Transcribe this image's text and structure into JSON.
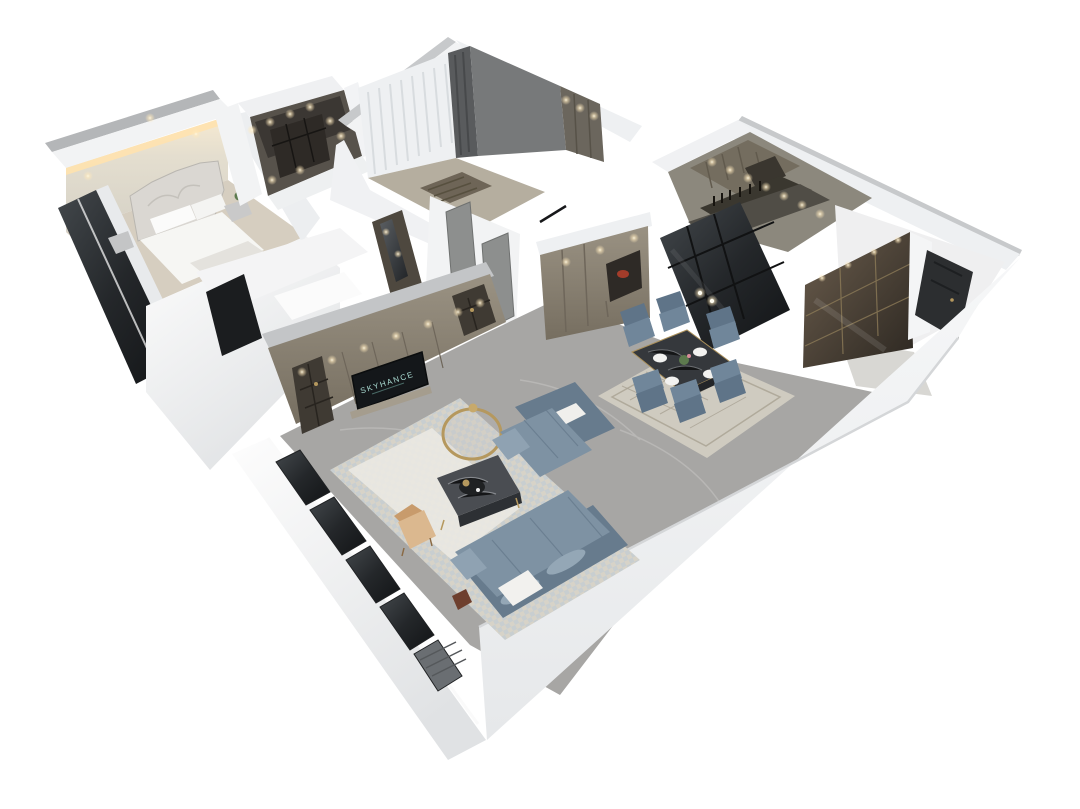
{
  "tv": {
    "logo_text": "SKYHANCE"
  },
  "colors": {
    "background": "#ffffff",
    "wall_white": "#f2f3f4",
    "wall_bright": "#fafbfb",
    "wall_shade": "#e2e4e6",
    "roof_edge": "#c7c9cb",
    "mirror_strip": "#b4b6b8",
    "accent_glow": "#ffe2ae",
    "accent_wall": "#ddd8cd",
    "bedroom_floor": "#d6cec0",
    "hall_floor": "#b5ae9f",
    "marble_floor": "#a7a6a4",
    "marble_light": "#d8d7d3",
    "kitchen_floor": "#504d46",
    "cabinet_taupe": "#8f8778",
    "cabinet_dark": "#3f3a33",
    "closet_dark": "#57524b",
    "shelf_dark": "#2e2a26",
    "glass_dark": "#1b1d1f",
    "curtain_sheer": "#eef0f2",
    "curtain_dark": "#595b5d",
    "wall_gray": "#77797a",
    "door_gray": "#8d8f8e",
    "door_dark": "#2c2e30",
    "bronze_cabinet": "#4a4236",
    "sofa_blue": "#7e92a3",
    "sofa_blue_dark": "#677b8d",
    "chair_teal": "#70869a",
    "chair_teal_dark": "#5f7488",
    "table_dark": "#35383c",
    "gold": "#b5985e",
    "rug_cream": "#d7d3c8",
    "rug_runner": "#eceae4",
    "dining_rug": "#cfcbc0",
    "tan_chair": "#dbb88f",
    "tan_chair_dark": "#c89b6c",
    "light_warm": "#ffd9a3",
    "tv_black": "#14171a",
    "tv_logo": "#aadbd2",
    "red_accent": "#a33c2a",
    "wood_red": "#6e3f2e",
    "plant_green": "#5d7a4e"
  }
}
